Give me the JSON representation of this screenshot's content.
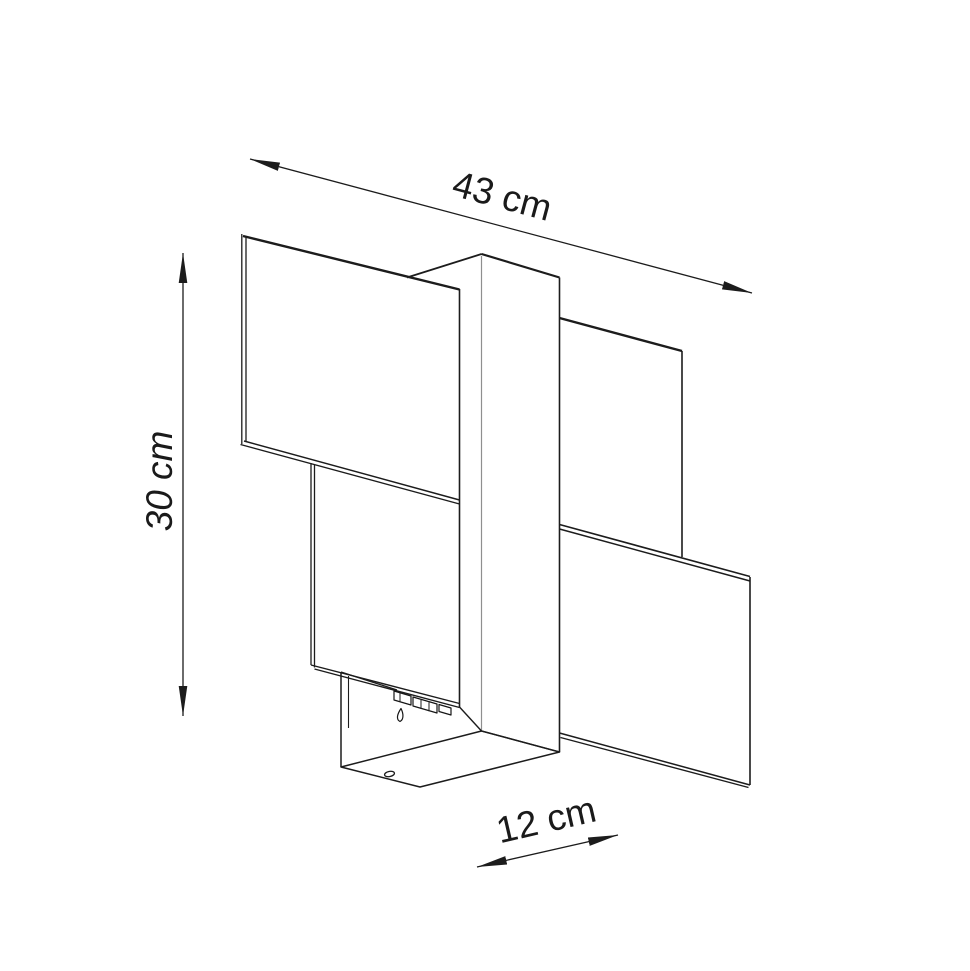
{
  "diagram": {
    "type": "product-dimension-drawing",
    "subject": "wall-lamp-line-art",
    "dimensions": {
      "width": {
        "label": "43 cm",
        "value": 43,
        "unit": "cm"
      },
      "height": {
        "label": "30 cm",
        "value": 30,
        "unit": "cm"
      },
      "depth": {
        "label": "12 cm",
        "value": 12,
        "unit": "cm"
      }
    },
    "colors": {
      "line": "#1c1c1c",
      "front_corner_line": "#8f8f8f",
      "background": "#ffffff",
      "text": "#1a1a1a"
    }
  }
}
